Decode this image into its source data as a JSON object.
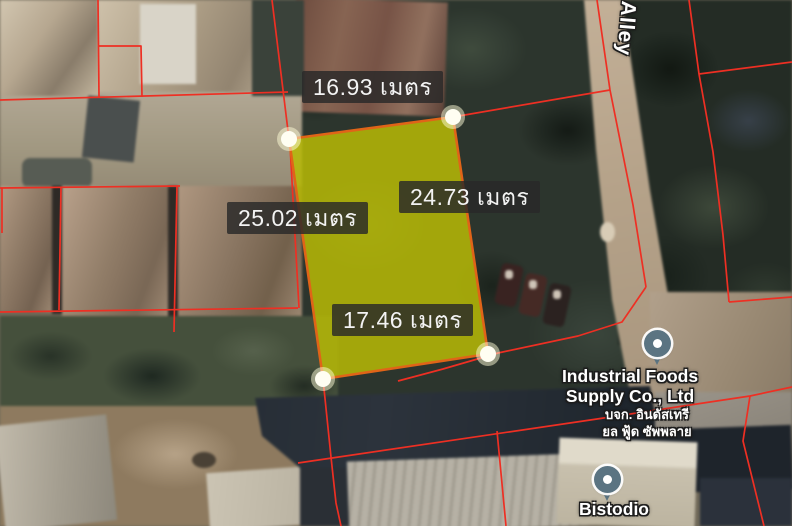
{
  "measurement_labels": {
    "top": {
      "text": "16.93 เมตร",
      "value": "16.93",
      "unit": "เมตร"
    },
    "right": {
      "text": "24.73 เมตร",
      "value": "24.73",
      "unit": "เมตร"
    },
    "left": {
      "text": "25.02 เมตร",
      "value": "25.02",
      "unit": "เมตร"
    },
    "bottom": {
      "text": "17.46 เมตร",
      "value": "17.46",
      "unit": "เมตร"
    }
  },
  "road_labels": {
    "alley": "Alley"
  },
  "place_labels": {
    "industrial_foods": {
      "name_line1": "Industrial Foods",
      "name_line2": "Supply Co., Ltd",
      "thai_line1": "บจก. อินดัสเทรี",
      "thai_line2": "ยล ฟู้ด ซัพพลาย"
    },
    "bistodio": {
      "name": "Bistodio"
    }
  },
  "plot_overlay": {
    "fill_color": "#b7b906",
    "border_color": "#e06418",
    "corner_marker_color": "#ffffff",
    "cadastral_line_color": "#ee2f23",
    "pin_color": "#5b7482",
    "label_background": "rgba(40,40,40,0.82)",
    "label_text_color": "#f3f3f3"
  }
}
